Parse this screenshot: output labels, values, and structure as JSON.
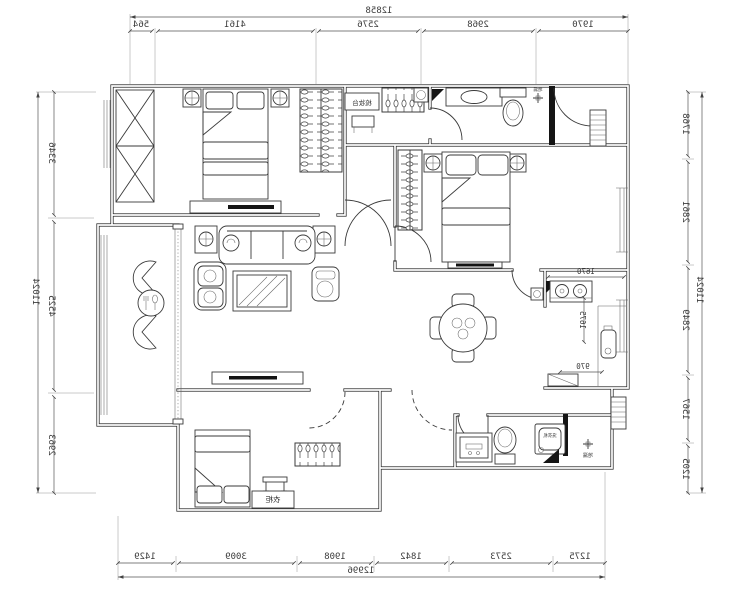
{
  "drawing": {
    "type": "apartment floor plan (mirrored CAD print)",
    "units": "mm",
    "line_color": "#3a3a3a",
    "wall_color": "#2a2a2a",
    "background": "#ffffff"
  },
  "dims": {
    "top": {
      "total": "12858",
      "seg": [
        "564",
        "4161",
        "2576",
        "2968",
        "1970"
      ]
    },
    "bottom": {
      "total": "12996",
      "seg": [
        "1429",
        "3009",
        "1908",
        "1842",
        "2573",
        "1275"
      ]
    },
    "left": {
      "total": "11024",
      "seg": [
        "3346",
        "4525",
        "2963"
      ]
    },
    "right": {
      "total": "11024",
      "seg": [
        "1768",
        "2861",
        "2849",
        "1567",
        "1205"
      ]
    },
    "kitchen": {
      "width": "1670",
      "depth": "1675",
      "pass": "970"
    }
  },
  "labels": {
    "dresser_table": "梳妆台",
    "wardrobe": "衣柜",
    "washing_machine": "洗衣机",
    "floor_drain_top": "地漏",
    "floor_drain_bottom": "地漏"
  }
}
